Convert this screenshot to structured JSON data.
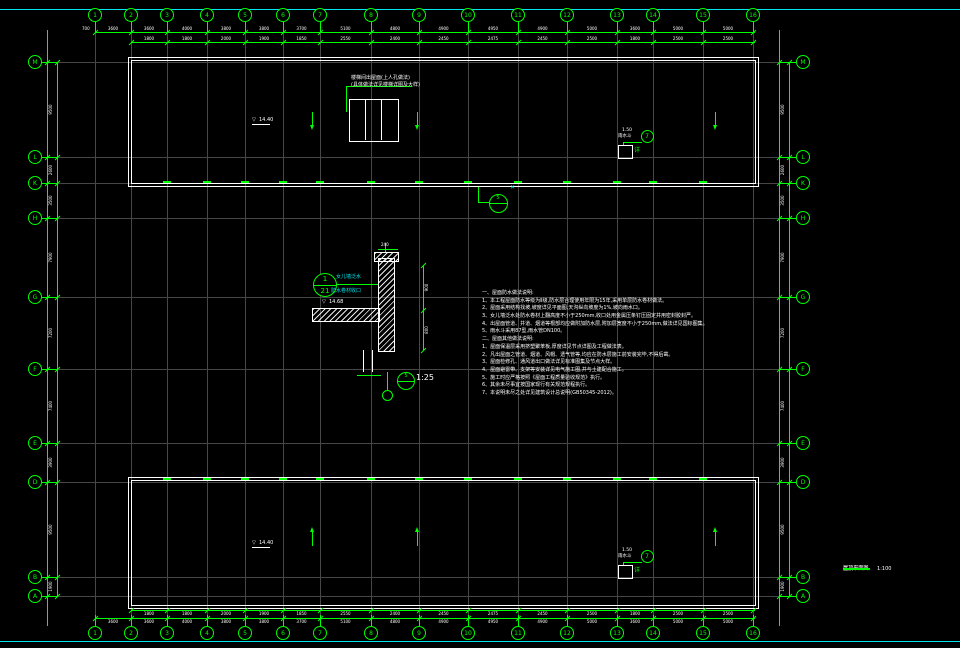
{
  "colors": {
    "background": "#000000",
    "cad_green": "#00ff00",
    "drawing_white": "#ffffff",
    "grid_gray": "#474747",
    "frame_cyan": "#00e5ee"
  },
  "frame": {
    "top_y": 9,
    "bottom_y": 641
  },
  "grid": {
    "columns": [
      {
        "label": "1",
        "x": 95
      },
      {
        "label": "2",
        "x": 131
      },
      {
        "label": "3",
        "x": 167
      },
      {
        "label": "4",
        "x": 207
      },
      {
        "label": "5",
        "x": 245
      },
      {
        "label": "6",
        "x": 283
      },
      {
        "label": "7",
        "x": 320
      },
      {
        "label": "8",
        "x": 371
      },
      {
        "label": "9",
        "x": 419
      },
      {
        "label": "10",
        "x": 468
      },
      {
        "label": "11",
        "x": 518
      },
      {
        "label": "12",
        "x": 567
      },
      {
        "label": "13",
        "x": 617
      },
      {
        "label": "14",
        "x": 653
      },
      {
        "label": "15",
        "x": 703
      },
      {
        "label": "16",
        "x": 753
      }
    ],
    "rows": [
      {
        "label": "M",
        "y": 62
      },
      {
        "label": "L",
        "y": 157
      },
      {
        "label": "K",
        "y": 183
      },
      {
        "label": "H",
        "y": 218
      },
      {
        "label": "G",
        "y": 297
      },
      {
        "label": "F",
        "y": 369
      },
      {
        "label": "E",
        "y": 443
      },
      {
        "label": "D",
        "y": 482
      },
      {
        "label": "B",
        "y": 577
      },
      {
        "label": "A",
        "y": 596
      }
    ]
  },
  "dimensions": {
    "top_row1": [
      "3600",
      "3600",
      "4000",
      "3800",
      "3800",
      "3700",
      "5100",
      "4800",
      "4900",
      "4950",
      "4900",
      "5000",
      "3600",
      "5000",
      "5000"
    ],
    "top_row2": [
      "1800",
      "1800",
      "2000",
      "1900",
      "1850",
      "2550",
      "2400",
      "2450",
      "2475",
      "2450",
      "2500",
      "1800",
      "2500",
      "2500"
    ],
    "left_col": [
      "9500",
      "2600",
      "3500",
      "7900",
      "7200",
      "7400",
      "3900",
      "9500",
      "1900"
    ],
    "left_lead": "700"
  },
  "buildings": [
    {
      "x": 128,
      "y": 57,
      "w": 629,
      "h": 128
    },
    {
      "x": 128,
      "y": 477,
      "w": 629,
      "h": 130
    }
  ],
  "stair": {
    "note_line1": "楼梯间出屋面(上人孔做法)",
    "note_line2": "(具体做法详见楼梯详图及大样)",
    "box": {
      "x": 349,
      "y": 99,
      "w": 48,
      "h": 41
    }
  },
  "levels": [
    {
      "x": 252,
      "y": 118,
      "text": "14.40"
    },
    {
      "x": 252,
      "y": 541,
      "text": "14.40"
    }
  ],
  "slope_arrows": [
    {
      "x": 312,
      "y": 112,
      "dir": "down"
    },
    {
      "x": 417,
      "y": 112,
      "dir": "down"
    },
    {
      "x": 715,
      "y": 112,
      "dir": "down"
    },
    {
      "x": 312,
      "y": 532,
      "dir": "up"
    },
    {
      "x": 417,
      "y": 532,
      "dir": "up"
    },
    {
      "x": 715,
      "y": 532,
      "dir": "up"
    }
  ],
  "drain": {
    "line1": "1.50",
    "line2": "雨水斗",
    "ref": "7",
    "tag": "详"
  },
  "drain_positions": [
    {
      "x": 618,
      "y": 129
    },
    {
      "x": 618,
      "y": 549
    }
  ],
  "callout5": {
    "num": "5",
    "cx": 497,
    "cy": 202
  },
  "x_mark": {
    "char": "✕",
    "x": 510,
    "y": 185
  },
  "detail": {
    "ref_top": "1",
    "ref_bottom": "21",
    "cyan1": "女儿墙泛水",
    "cyan2": "防水卷材收口",
    "level": "14.68",
    "dim_top": "240",
    "dim_r1": "900",
    "dim_r2": "800",
    "scale_ref": "5",
    "scale": "1:25"
  },
  "notes": {
    "lines": [
      "一、屋面防水做法说明:",
      "1、本工程屋面防水等级为Ⅱ级,防水层合理使用年限为15年,采用单层防水卷材做法。",
      "2、屋面采用结构找坡,坡度详见平面图,天沟纵向坡度为1%,坡向雨水口。",
      "3、女儿墙泛水处防水卷材上翻高度不小于250mm,收口处用金属压条钉压固定并用密封胶封严。",
      "4、出屋面管道、井道、烟道等根部均应做附加防水层,附加层宽度不小于250mm,做法详见国标图集。",
      "5、雨水斗采用87型,雨水管DN100。",
      "二、屋面其他做法说明:",
      "1、屋面保温层采用挤塑聚苯板,厚度详见节点详图及工程做法表。",
      "2、凡出屋面之管道、烟道、风帽、透气管等,均应在防水层施工前安装完毕,不得后凿。",
      "3、屋面检修孔、通风道出口做法详见标准图集及节点大样。",
      "4、屋面避雷带、支架等安装详见电气施工图,并与土建配合施工。",
      "5、施工时应严格按照《屋面工程质量验收规范》执行。",
      "6、其余未尽事宜按国家现行有关规范规程执行。",
      "7、本说明未尽之处详见建筑设计总说明(GB50345-2012)。"
    ]
  },
  "title_block": {
    "title": "屋顶平面图",
    "scale": "1:100"
  }
}
